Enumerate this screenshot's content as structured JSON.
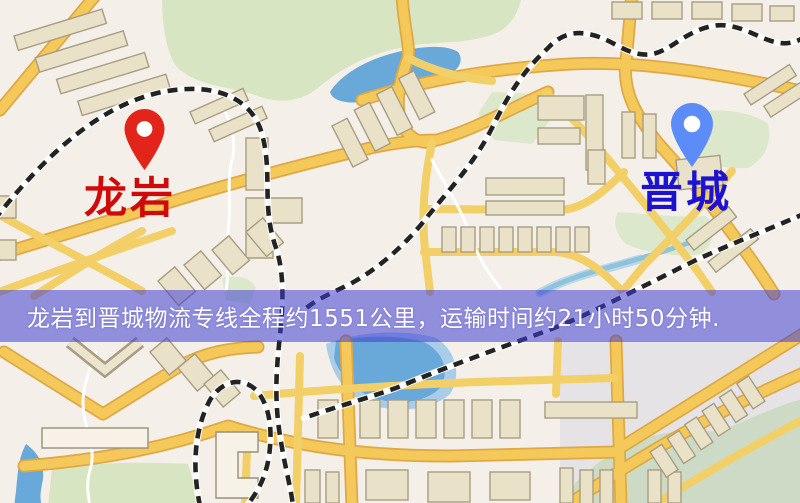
{
  "banner": {
    "text": "龙岩到晋城物流专线全程约1551公里，运输时间约21小时50分钟.",
    "background_color": "#4242d2",
    "text_color": "#ffffff"
  },
  "markers": {
    "origin": {
      "label": "龙岩",
      "icon": "map-pin",
      "pin_color": "#e3241b",
      "label_color": "#cf0a0a"
    },
    "destination": {
      "label": "晋城",
      "icon": "map-pin",
      "pin_color": "#5b8cf7",
      "label_color": "#1d12cf"
    }
  },
  "route_info": {
    "origin": "龙岩",
    "destination": "晋城",
    "service": "物流专线",
    "distance_text": "约1551公里",
    "duration_text": "约21小时50分钟"
  },
  "map_colors": {
    "background": "#f4efe8",
    "road": "#f4c95a",
    "road_casing": "#dfa845",
    "building": "#eae2c8",
    "park": "#d7e5c2",
    "water": "#68a9da",
    "railway": "#232323"
  }
}
